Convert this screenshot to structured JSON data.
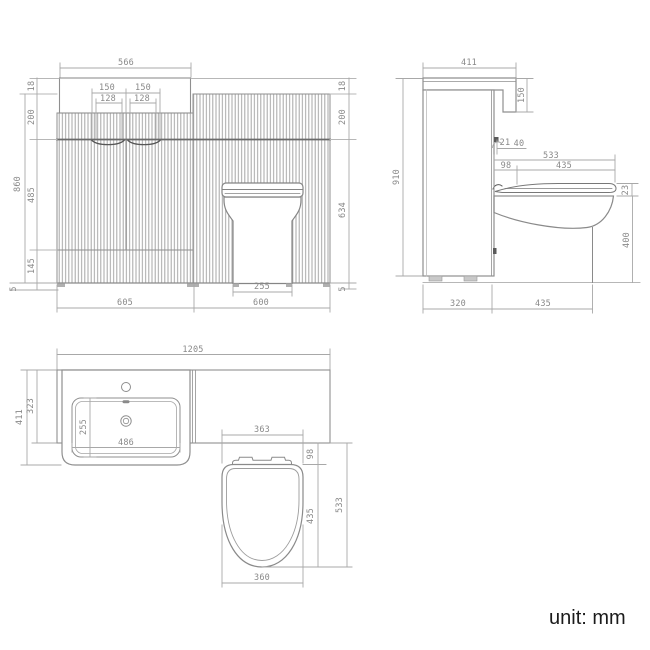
{
  "unit_label": "unit: mm",
  "views": {
    "front": {
      "title": "front-elevation",
      "dims": {
        "countertop_width": "566",
        "handle_left": "150",
        "handle_right": "150",
        "handle_left_inner": "128",
        "handle_right_inner": "128",
        "counter_thickness_left": "18",
        "counter_thickness_right": "18",
        "upper_panel_left": "200",
        "upper_panel_right": "200",
        "overall_height": "860",
        "door_panel_height": "485",
        "plinth_height": "145",
        "foot_left": "5",
        "foot_right": "5",
        "wc_panel_height": "634",
        "vanity_unit_width": "605",
        "wc_unit_width": "600",
        "pan_base_width": "255"
      }
    },
    "side": {
      "title": "side-elevation",
      "dims": {
        "countertop_depth": "411",
        "countertop_drop": "150",
        "overall_height": "910",
        "seat_gap": "21",
        "hinge_size": "40",
        "pan_depth": "533",
        "seat_setback": "98",
        "seat_length": "435",
        "seat_thickness": "23",
        "bowl_height": "400",
        "cabinet_depth": "320",
        "pan_projection": "435"
      }
    },
    "plan": {
      "title": "plan-view",
      "dims": {
        "overall_width": "1205",
        "overall_depth": "411",
        "countertop_depth": "323",
        "basin_depth": "255",
        "basin_width": "486",
        "pan_back_width": "363",
        "seat_setback": "98",
        "seat_length": "435",
        "pan_projection": "533",
        "pan_width": "360"
      }
    }
  }
}
